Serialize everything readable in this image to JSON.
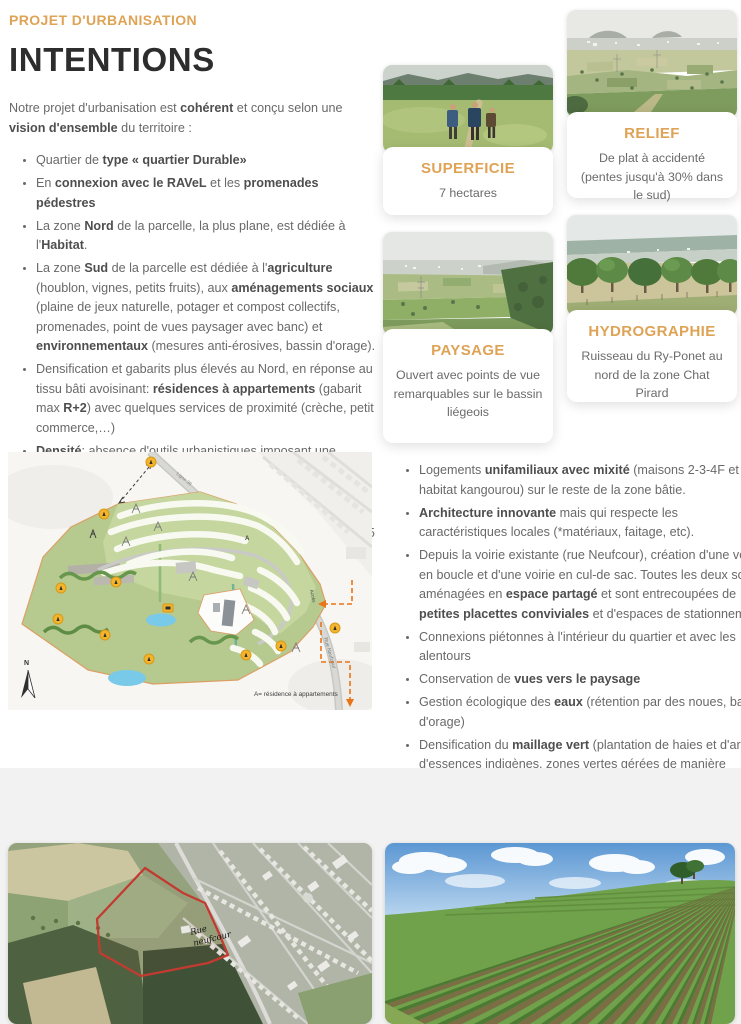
{
  "colors": {
    "accent": "#dfa356",
    "heading": "#2d2d2d",
    "body_text": "#696969",
    "section_bg": "#f2f2f2",
    "parcel_outline_red": "#c23b30",
    "map_marker_orange": "#f4b52c"
  },
  "header": {
    "kicker": "PROJET D'URBANISATION",
    "title": "INTENTIONS"
  },
  "intro": [
    {
      "t": "Notre projet d'urbanisation est "
    },
    {
      "t": "cohérent",
      "b": true
    },
    {
      "t": " et conçu selon une "
    },
    {
      "t": "vision d'ensemble",
      "b": true
    },
    {
      "t": " du territoire :"
    }
  ],
  "left_bullets": [
    [
      {
        "t": "Quartier de "
      },
      {
        "t": "type « quartier Durable»",
        "b": true
      }
    ],
    [
      {
        "t": "En "
      },
      {
        "t": "connexion avec le RAVeL",
        "b": true
      },
      {
        "t": " et les "
      },
      {
        "t": "promenades pédestres",
        "b": true
      }
    ],
    [
      {
        "t": "La zone "
      },
      {
        "t": "Nord",
        "b": true
      },
      {
        "t": " de la parcelle, la plus plane, est dédiée à l'"
      },
      {
        "t": "Habitat",
        "b": true
      },
      {
        "t": "."
      }
    ],
    [
      {
        "t": "La zone "
      },
      {
        "t": "Sud",
        "b": true
      },
      {
        "t": " de la parcelle est dédiée à l'"
      },
      {
        "t": "agriculture",
        "b": true
      },
      {
        "t": " (houblon, vignes, petits fruits), aux "
      },
      {
        "t": "aménagements sociaux",
        "b": true
      },
      {
        "t": " (plaine de jeux naturelle, potager et compost collectifs, promenades, point de vues paysager avec banc) et "
      },
      {
        "t": "environnementaux",
        "b": true
      },
      {
        "t": " (mesures anti-érosives, bassin d'orage)."
      }
    ],
    [
      {
        "t": "Densification et gabarits plus élevés au Nord, en réponse au tissu bâti avoisinant: "
      },
      {
        "t": "résidences à appartements",
        "b": true
      },
      {
        "t": " (gabarit max "
      },
      {
        "t": "R+2",
        "b": true
      },
      {
        "t": ") avec quelques services de proximité (crèche, petit commerce,…)"
      }
    ],
    [
      {
        "t": "Densité",
        "b": true
      },
      {
        "t": ": absence d'outils urbanistiques imposant une densité – "
      },
      {
        "t": "Référentiel quartier durable",
        "i": true
      },
      {
        "t": " (qui préconise une densité nette* de min. 30 log/ha dans les bourgs, comme Beyne Heusay)."
      }
    ],
    [
      {
        "t": "Parcelle de 6 ha mais urbanisation que de la partie Nord: 3,5 ha"
      }
    ],
    [
      {
        "t": "Estimation du nombre de logements: environ 55 appartements et 70 maisons unifamiliales = "
      },
      {
        "t": "125 nouveaux logements.",
        "b": true
      }
    ]
  ],
  "cards": [
    {
      "title": "SUPERFICIE",
      "text": "7 hectares",
      "image": "hikers-meadow-photo"
    },
    {
      "title": "RELIEF",
      "text": "De plat à accidenté (pentes jusqu'à 30% dans le sud)",
      "image": "panorama-valley-photo"
    },
    {
      "title": "PAYSAGE",
      "text": "Ouvert avec points de vue remarquables sur le bassin liégeois",
      "image": "open-landscape-photo"
    },
    {
      "title": "HYDROGRAPHIE",
      "text": "Ruisseau du Ry-Ponet au nord de la zone Chat Pirard",
      "image": "tree-row-meadow-photo"
    }
  ],
  "right_bullets": [
    [
      {
        "t": "Logements "
      },
      {
        "t": "unifamiliaux avec mixité",
        "b": true
      },
      {
        "t": " (maisons 2-3-4F et habitat kangourou) sur le reste de la zone bâtie."
      }
    ],
    [
      {
        "t": "Architecture innovante",
        "b": true
      },
      {
        "t": " mais qui respecte les caractéristiques locales (*matériaux, faitage, etc)."
      }
    ],
    [
      {
        "t": "Depuis la voirie existante (rue Neufcour), création d'une voirie en boucle et d'une voirie en cul-de sac. Toutes les deux sont aménagées en "
      },
      {
        "t": "espace partagé",
        "b": true
      },
      {
        "t": " et sont entrecoupées de "
      },
      {
        "t": "petites placettes conviviales",
        "b": true
      },
      {
        "t": " et d'espaces de stationnement."
      }
    ],
    [
      {
        "t": "Connexions piétonnes à l'intérieur du quartier et avec les alentours"
      }
    ],
    [
      {
        "t": "Conservation de "
      },
      {
        "t": "vues vers le paysage",
        "b": true
      }
    ],
    [
      {
        "t": "Gestion écologique des "
      },
      {
        "t": "eaux",
        "b": true
      },
      {
        "t": " (rétention par des noues, bassin d'orage)"
      }
    ],
    [
      {
        "t": "Densification du "
      },
      {
        "t": "maillage vert",
        "b": true
      },
      {
        "t": " (plantation de haies et d'arbres d'essences indigènes, zones vertes gérées de manière différenciée)"
      }
    ]
  ],
  "site_plan": {
    "labels": {
      "railway": "Ligne 38",
      "street": "Rue Neufcour",
      "access": "Accès",
      "building_marker": "A",
      "legend": "A= résidence à appartements",
      "north": "N"
    }
  },
  "aerial": {
    "street_line1": "Rue",
    "street_line2": "neufcour"
  }
}
